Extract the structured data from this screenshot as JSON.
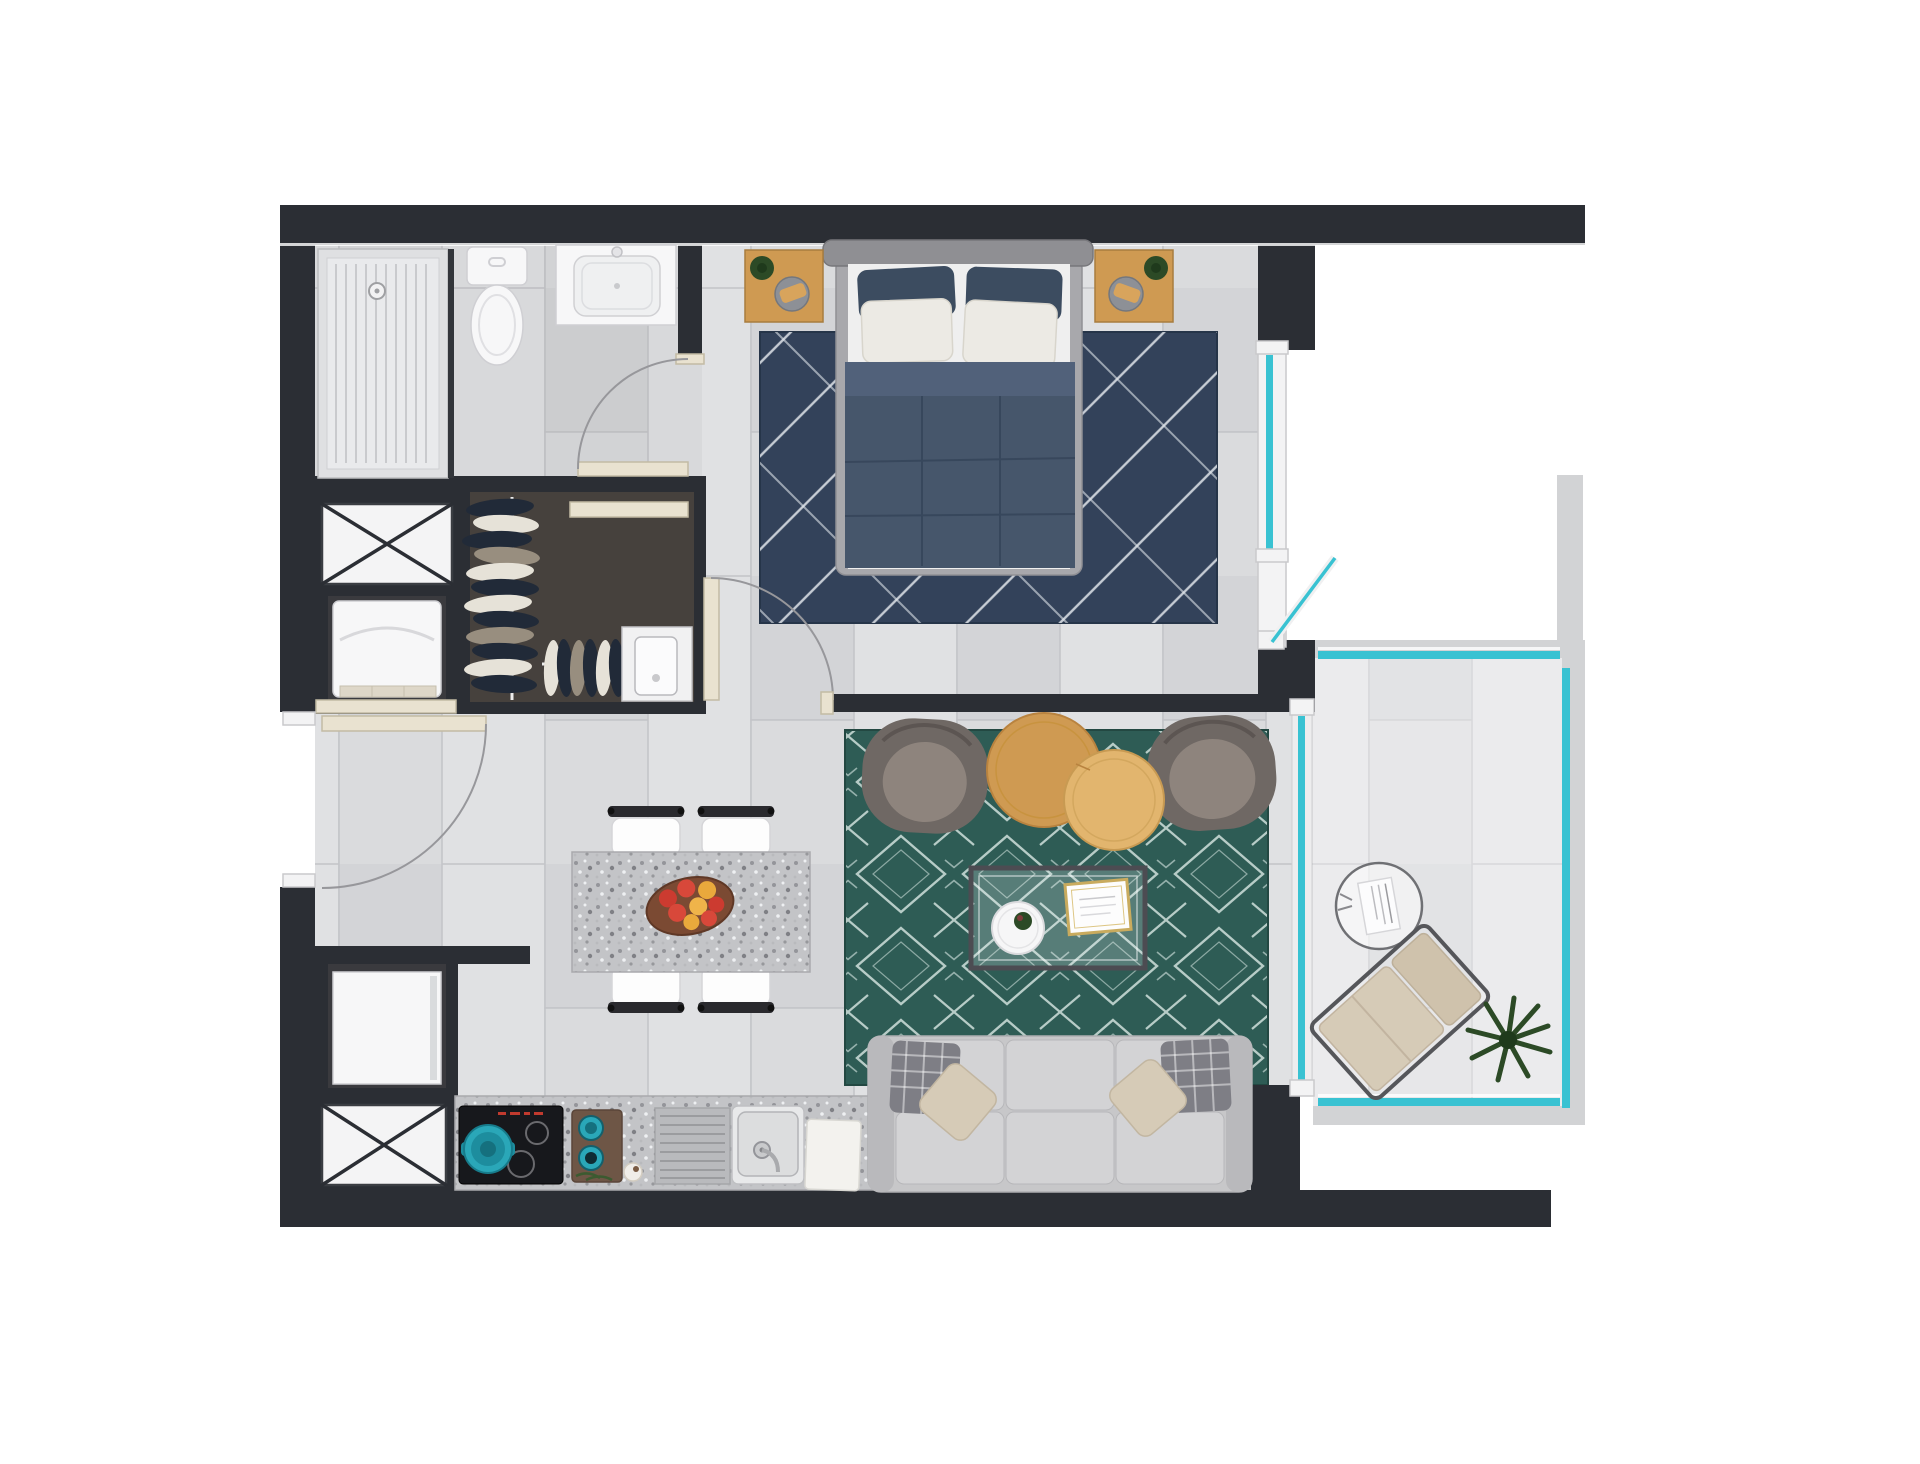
{
  "meta": {
    "title": "apartment-floor-plan",
    "style": "top-down 3d rendered floor plan, no visible text labels",
    "canvas": {
      "width": 1920,
      "height": 1464
    }
  },
  "palette": {
    "wall": "#2b2e34",
    "floor_base": "#dadbdd",
    "floor_plank_light": "#e0e1e3",
    "floor_plank_dark": "#d3d4d7",
    "tile_line": "#c3c4c8",
    "slab": "#d2d3d5",
    "glass_teal": "#39c2d2",
    "frame_white": "#f3f3f4",
    "door_beige": "#e9e2d0",
    "arc_gray": "#97979b",
    "fixture_white": "#f7f7f8",
    "fixture_line": "#cfcfd3",
    "bedroom_rug": "#33425a",
    "bedroom_rug_line": "#dfe4ea",
    "living_rug": "#2e5c55",
    "living_rug_line": "#d9e8e4",
    "wood_light": "#e2b56e",
    "wood_mid": "#cf9a52",
    "granite_base": "#c3c4c7",
    "sofa_base": "#c7c7c9",
    "sofa_seat": "#d3d3d5",
    "cushion_plaid": "#7e7e85",
    "pillow_beige": "#d6cbb7",
    "armchair_outer": "#6f6864",
    "armchair_cushion": "#8e847d",
    "appliance_dark": "#17181c",
    "pot_teal": "#2aa7b8",
    "plant_green": "#2c4a26",
    "apple_red": "#cc3b30",
    "apple_yellow": "#e9a93c",
    "fruit_plate": "#7b4a33",
    "closet_floor": "#46413d",
    "cloth_dark": "#212a38",
    "cloth_light": "#e6e2d8",
    "cloth_tan": "#988e7f"
  },
  "rooms": [
    {
      "id": "bathroom",
      "name": "Bathroom",
      "furniture": [
        "shower tray with drain",
        "glass divider",
        "toilet",
        "vanity sink",
        "swing door with arc"
      ]
    },
    {
      "id": "storage-column",
      "name": "Service niches (left wall)",
      "furniture": [
        "crossed appliance provision box (upper)",
        "washing machine niche",
        "refrigerator niche",
        "crossed appliance provision box (lower)"
      ]
    },
    {
      "id": "closet",
      "name": "Walk-in closet",
      "furniture": [
        "hanging clothes on two rails",
        "white storage cabinet",
        "sliding track"
      ]
    },
    {
      "id": "hallway",
      "name": "Entrance hall",
      "furniture": [
        "entrance door with swing arc",
        "bedroom swing door"
      ]
    },
    {
      "id": "bedroom",
      "name": "Bedroom",
      "furniture": [
        "double bed with navy duvet, 2 navy + 2 white pillows",
        "2 wooden nightstands with plant and tray",
        "navy rug with white diagonal lines",
        "tilt-open window with teal glazing"
      ]
    },
    {
      "id": "kitchen",
      "name": "Kitchen",
      "furniture": [
        "granite counter",
        "black cooktop with teal pot",
        "wooden board with 2 teal pots",
        "ribbed drainboard",
        "steel sink",
        "white cutting board"
      ]
    },
    {
      "id": "dining",
      "name": "Dining area",
      "furniture": [
        "granite dining table",
        "4 white chairs",
        "wooden plate with apples"
      ]
    },
    {
      "id": "living",
      "name": "Living room",
      "furniture": [
        "teal geometric rug",
        "2 gray armchairs",
        "2 round wooden nesting coffee tables",
        "glass coffee table with round tray, plant and gold-frame tray",
        "3-seat gray sofa with plaid cushions and beige pillows"
      ]
    },
    {
      "id": "balcony",
      "name": "Balcony",
      "furniture": [
        "teal glass railing",
        "teal sliding glass door",
        "round side table with magazine",
        "beige lounge chair",
        "potted plant"
      ]
    }
  ]
}
